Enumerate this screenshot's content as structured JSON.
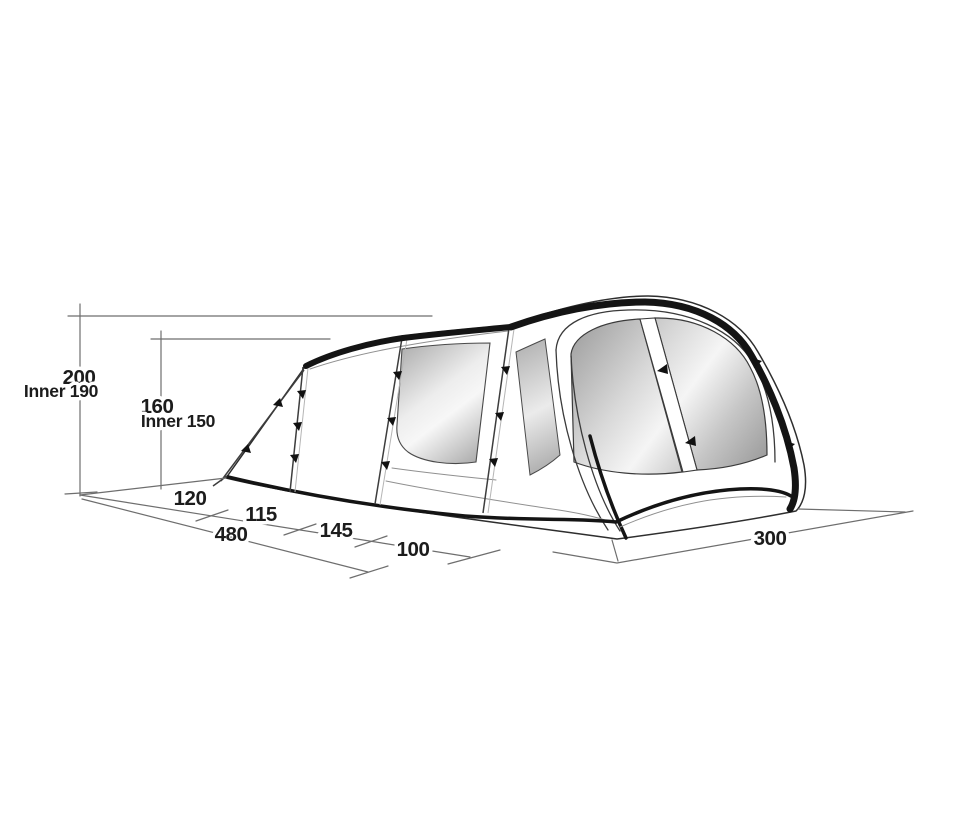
{
  "diagram": {
    "kind": "tent-dimension-drawing",
    "background": "#ffffff",
    "labels": {
      "height_outer": "200",
      "height_outer_inner": "Inner 190",
      "height_mid": "160",
      "height_mid_inner": "Inner 150",
      "depth_seg1": "120",
      "depth_seg2": "115",
      "depth_seg3": "145",
      "depth_seg4": "100",
      "depth_total": "480",
      "front_width": "300"
    },
    "colors": {
      "ink": "#1c1c1c",
      "dimension_line": "#6e6e6e",
      "tent_outline": "#2e2e2e",
      "pole_band": "#141414",
      "glass_dark": "#9a9a9a",
      "glass_light": "#f4f4f4",
      "canvas": "#ffffff"
    }
  }
}
